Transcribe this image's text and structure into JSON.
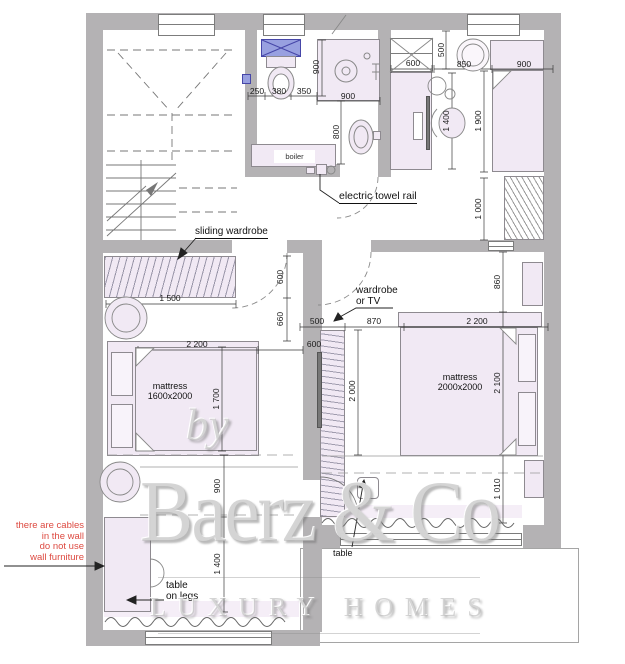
{
  "labels": {
    "sliding_wardrobe": "sliding wardrobe",
    "wardrobe_tv_1": "wardrobe",
    "wardrobe_tv_2": "or TV",
    "towel_rail": "electric towel rail",
    "boiler": "boiler",
    "mattress_left_1": "mattress",
    "mattress_left_2": "1600x2000",
    "mattress_right_1": "mattress",
    "mattress_right_2": "2000x2000",
    "table_legs_1": "table",
    "table_legs_2": "on legs",
    "table_small": "table"
  },
  "note": {
    "lines": [
      "there are cables",
      "in the wall",
      "do not use",
      "wall furniture"
    ]
  },
  "dims": {
    "wc_250": "250",
    "wc_380": "380",
    "wc_350": "350",
    "shower_depth": "900",
    "shower_width": "900",
    "sink_800": "800",
    "closet_600": "600",
    "top_500": "500",
    "gap_850": "850",
    "bed_single_900": "900",
    "desk_1400": "1 400",
    "bed_single_1900": "1 900",
    "entry_1000": "1 000",
    "wardrobe_600": "600",
    "wardrobe_1500": "1 500",
    "gap_660": "660",
    "bed1_2200": "2 200",
    "gap_600": "600",
    "bed1_1700": "1 700",
    "low_900": "900",
    "low_1400": "1 400",
    "tv_500": "500",
    "gap_870": "870",
    "corr_2000": "2 000",
    "bed2_2200": "2 200",
    "gap_860": "860",
    "bed2_2100": "2 100",
    "gap_1010": "1 010"
  },
  "watermark": {
    "by": "by",
    "brand": "Baerz & Co",
    "tagline": "LUXURY HOMES"
  },
  "colors": {
    "wall": "#b4b2b4",
    "furniture": "#f1e9f4",
    "washer_blue": "#98a0e0",
    "note_red": "#dd4a41"
  }
}
